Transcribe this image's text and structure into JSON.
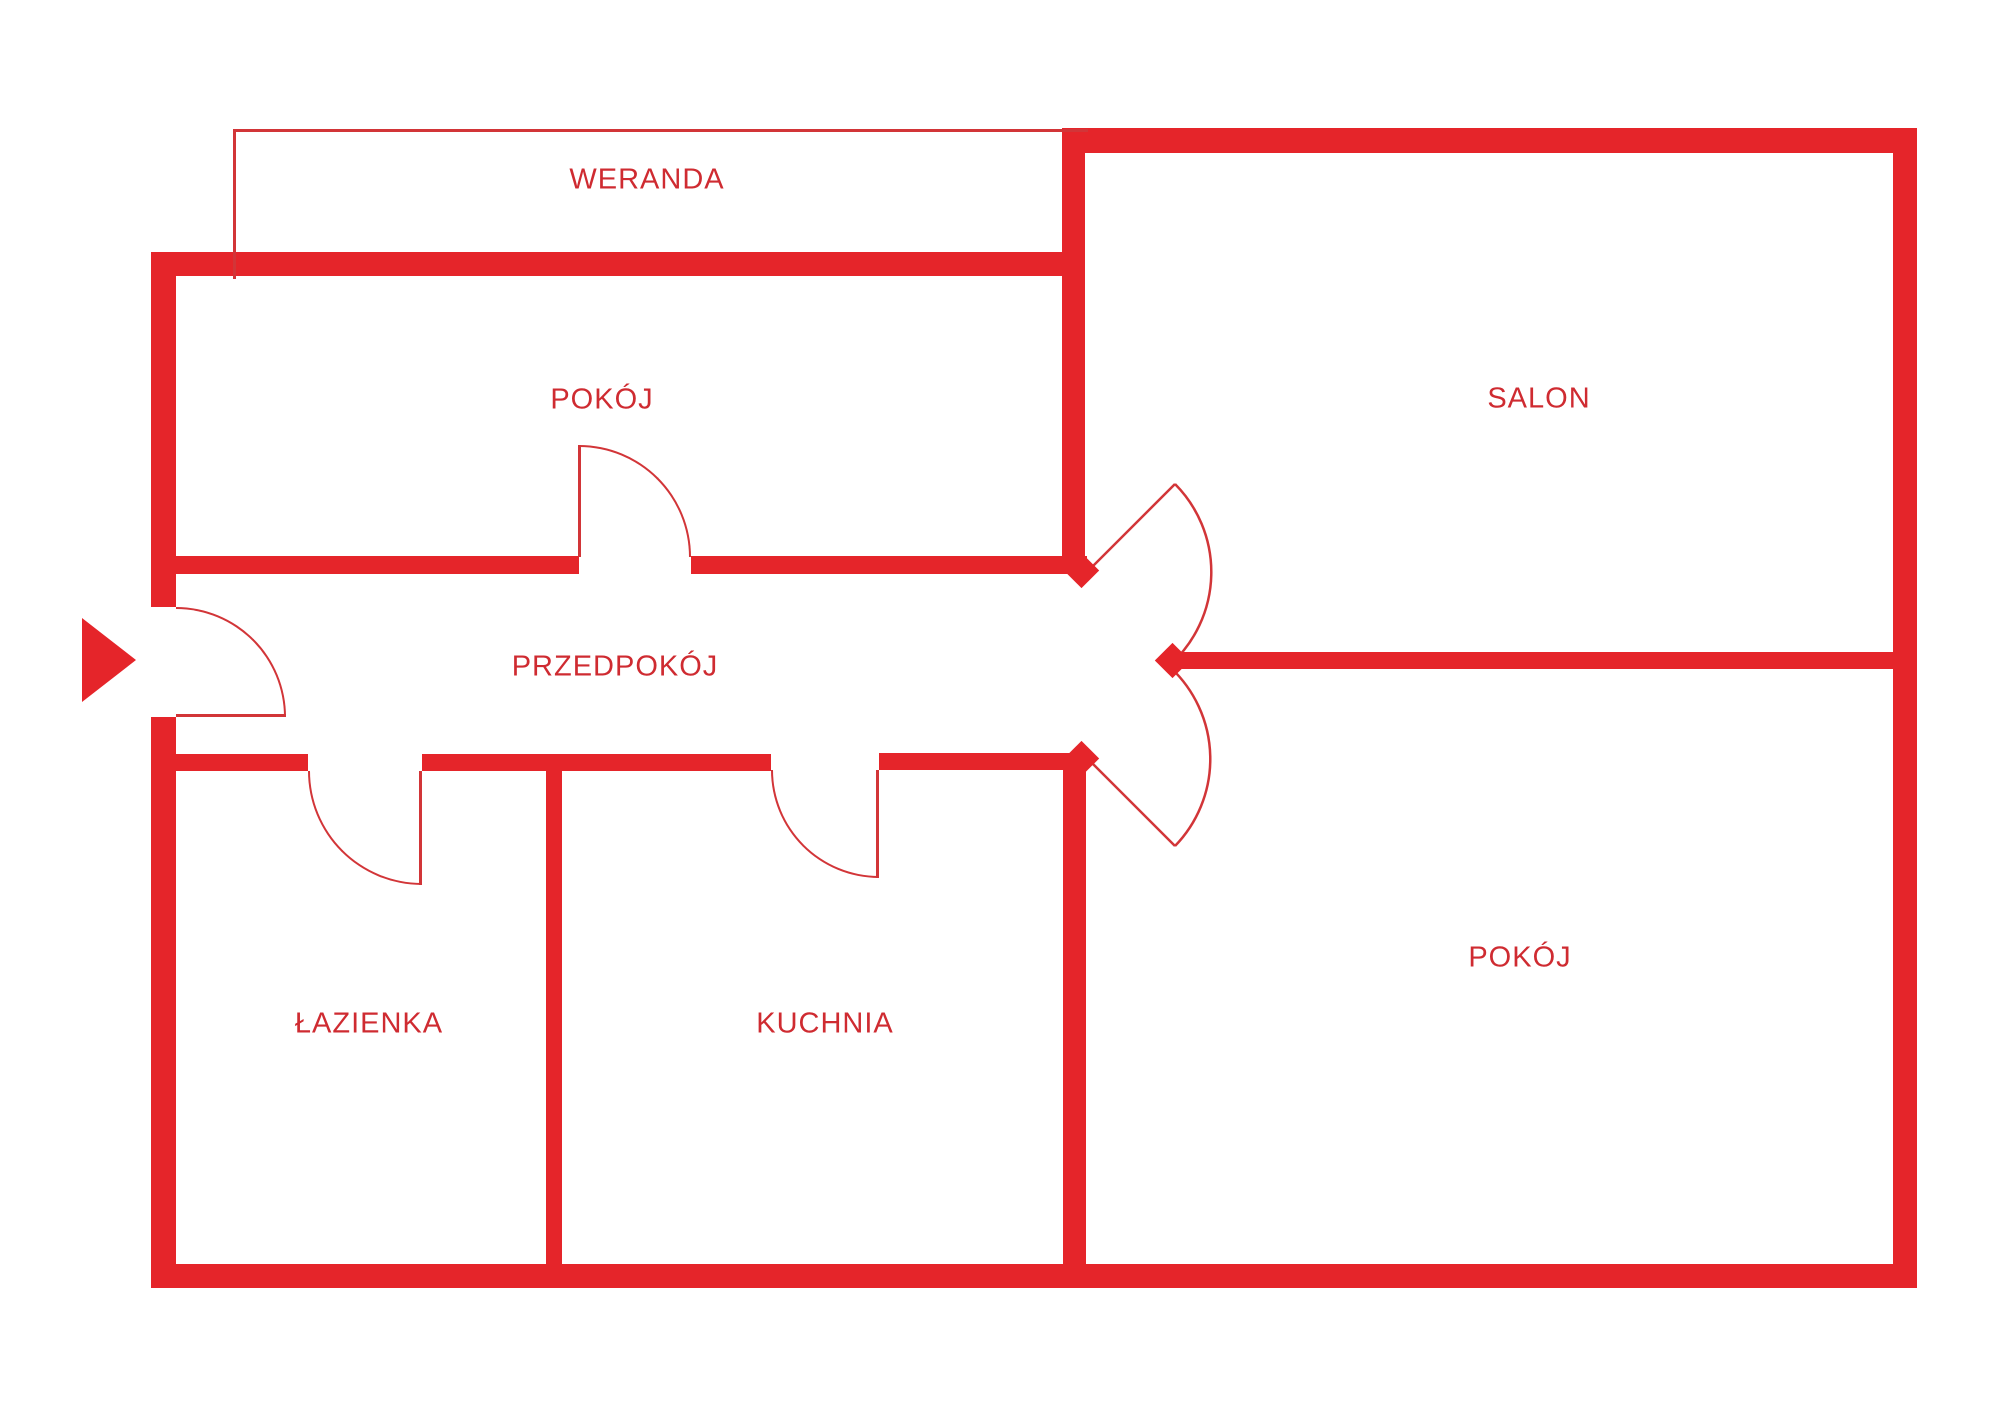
{
  "meta": {
    "canvas_width": 2000,
    "canvas_height": 1416
  },
  "colors": {
    "wall_red": "#e5252a",
    "thin_line_red": "#d23538",
    "label_red": "#cf2b31",
    "background": "#ffffff"
  },
  "rooms": [
    {
      "id": "weranda",
      "label": "WERANDA",
      "cx": 647,
      "cy": 180
    },
    {
      "id": "pokoj-top",
      "label": "POKÓJ",
      "cx": 602,
      "cy": 400
    },
    {
      "id": "salon",
      "label": "SALON",
      "cx": 1539,
      "cy": 399
    },
    {
      "id": "przedpokoj",
      "label": "PRZEDPOKÓJ",
      "cx": 615,
      "cy": 667
    },
    {
      "id": "lazienka",
      "label": "ŁAZIENKA",
      "cx": 369,
      "cy": 1024
    },
    {
      "id": "kuchnia",
      "label": "KUCHNIA",
      "cx": 825,
      "cy": 1024
    },
    {
      "id": "pokoj-bottom",
      "label": "POKÓJ",
      "cx": 1520,
      "cy": 958
    }
  ],
  "geometry": {
    "walls": [
      {
        "name": "outer-wall-left-upper",
        "x": 151,
        "y": 252,
        "w": 25,
        "h": 355
      },
      {
        "name": "outer-wall-left-lower",
        "x": 151,
        "y": 717,
        "w": 25,
        "h": 571
      },
      {
        "name": "top-wall-left-section",
        "x": 151,
        "y": 252,
        "w": 934,
        "h": 24
      },
      {
        "name": "salon-top-wall",
        "x": 1062,
        "y": 128,
        "w": 855,
        "h": 25
      },
      {
        "name": "outer-wall-right",
        "x": 1893,
        "y": 128,
        "w": 24,
        "h": 1160
      },
      {
        "name": "outer-wall-bottom",
        "x": 151,
        "y": 1264,
        "w": 1766,
        "h": 24
      },
      {
        "name": "center-divider-upper",
        "x": 1062,
        "y": 128,
        "w": 23,
        "h": 432
      },
      {
        "name": "hall-top-wall-left",
        "x": 176,
        "y": 556,
        "w": 403,
        "h": 18
      },
      {
        "name": "hall-top-wall-right",
        "x": 691,
        "y": 556,
        "w": 396,
        "h": 18
      },
      {
        "name": "hall-bottom-wall-a",
        "x": 176,
        "y": 754,
        "w": 132,
        "h": 17
      },
      {
        "name": "hall-bottom-wall-b",
        "x": 422,
        "y": 754,
        "w": 349,
        "h": 17
      },
      {
        "name": "hall-bottom-wall-c",
        "x": 879,
        "y": 753,
        "w": 208,
        "h": 17
      },
      {
        "name": "salon-bottom-wall",
        "x": 1175,
        "y": 652,
        "w": 718,
        "h": 17
      },
      {
        "name": "bathroom-kitchen-divider",
        "x": 546,
        "y": 754,
        "w": 16,
        "h": 534
      },
      {
        "name": "bottom-room-left-wall",
        "x": 1063,
        "y": 762,
        "w": 23,
        "h": 526
      }
    ],
    "diamonds": [
      {
        "name": "wall-point-hall-top-end",
        "cx": 1081,
        "cy": 570,
        "size": 25
      },
      {
        "name": "wall-point-hall-bottom-end",
        "cx": 1081,
        "cy": 758,
        "size": 25
      },
      {
        "name": "wall-point-salon-wall-end",
        "cx": 1172,
        "cy": 660,
        "size": 25
      }
    ],
    "veranda_outline": {
      "x": 233,
      "y": 129,
      "w": 852,
      "h": 147
    },
    "entrance_arrow": {
      "x": 82,
      "y": 618
    },
    "arc_doors": [
      {
        "name": "entrance-door-arc",
        "x": 176,
        "y": 607,
        "size": 110,
        "quadrant": "q-ne",
        "leaf": {
          "x": 176,
          "y": 714,
          "w": 110,
          "h": 3
        }
      },
      {
        "name": "room-top-door-arc",
        "x": 579,
        "y": 445,
        "size": 112,
        "quadrant": "q-ne",
        "leaf": {
          "x": 578,
          "y": 445,
          "w": 3,
          "h": 112
        }
      },
      {
        "name": "bathroom-door-arc",
        "x": 308,
        "y": 771,
        "size": 114,
        "quadrant": "q-sw",
        "leaf": {
          "x": 419,
          "y": 771,
          "w": 3,
          "h": 114
        }
      },
      {
        "name": "kitchen-door-arc",
        "x": 771,
        "y": 770,
        "size": 108,
        "quadrant": "q-sw",
        "leaf": {
          "x": 876,
          "y": 770,
          "w": 3,
          "h": 108
        }
      }
    ],
    "svg_doors": [
      {
        "name": "salon-door",
        "leaf_d": "M 1087 572 L 1175 484",
        "arc_d": "M 1175 484 A 125 125 0 0 1 1171 664"
      },
      {
        "name": "bottom-room-door",
        "leaf_d": "M 1087 758 L 1175 846",
        "arc_d": "M 1175 846 A 125 125 0 0 0 1171 668"
      }
    ]
  }
}
